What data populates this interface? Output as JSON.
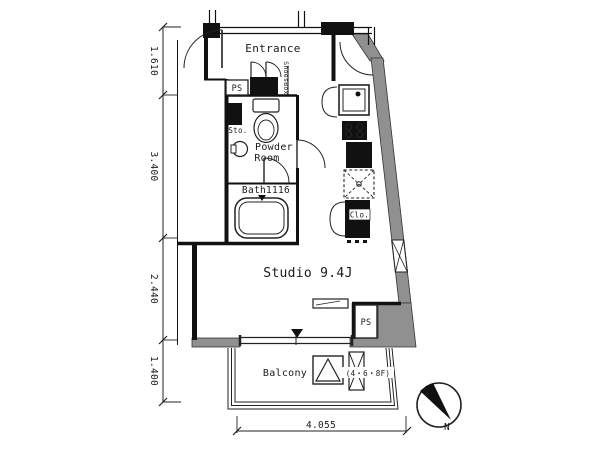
{
  "plan": {
    "labels": {
      "entrance": "Entrance",
      "shoes_box": "ShoesBox",
      "ps_top": "PS",
      "storage": "Sto.",
      "powder_line1": "Powder",
      "powder_line2": "Room",
      "bath": "Bath1116",
      "closet": "Clo.",
      "studio": "Studio 9.4J",
      "ps_bottom": "PS",
      "balcony": "Balcony",
      "floor_note": "(4・6・8F)",
      "north": "N"
    },
    "dimensions": {
      "left": [
        "1.610",
        "3.400",
        "2.440",
        "1.400"
      ],
      "bottom": "4.055"
    },
    "colors": {
      "wall_gray": "#909090",
      "ink": "#1a1a1a",
      "background": "#ffffff"
    },
    "fixtures": [
      "entrance-door-icon",
      "shoes-box-icon",
      "toilet-icon",
      "sink-icon",
      "bathtub-icon",
      "washing-machine-icon",
      "stove-icon",
      "counter-icon",
      "kitchen-sink-icon",
      "closet-icon",
      "window-icon",
      "shelf-icon",
      "evacuation-hatch-icon",
      "evacuation-ladder-icon",
      "north-arrow-icon"
    ]
  }
}
